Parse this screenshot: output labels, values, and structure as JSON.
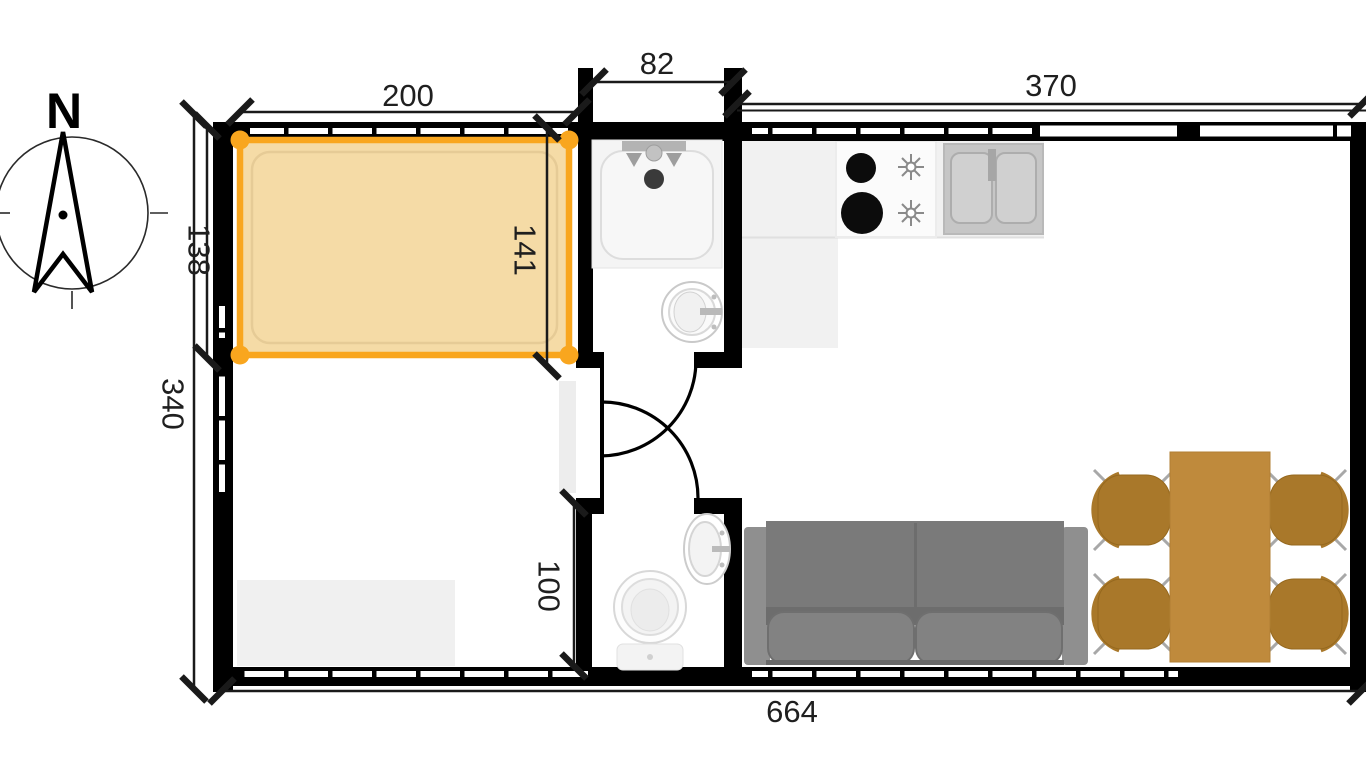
{
  "compass": {
    "north_label": "N"
  },
  "dimensions": {
    "bed_width": "200",
    "bathroom_width": "82",
    "kitchen_width": "370",
    "bed_depth": "138",
    "bed_inner": "141",
    "left_total": "340",
    "wc_height": "100",
    "bottom_total": "664"
  },
  "colors": {
    "selection": "#F9A61E",
    "bed_fill": "#F5DBA6",
    "table_wood": "#BF8A3C",
    "chair_wood": "#A9782A",
    "sofa_body": "#7A7A7A",
    "sofa_arm": "#8F8F8F",
    "wall": "#000000"
  }
}
